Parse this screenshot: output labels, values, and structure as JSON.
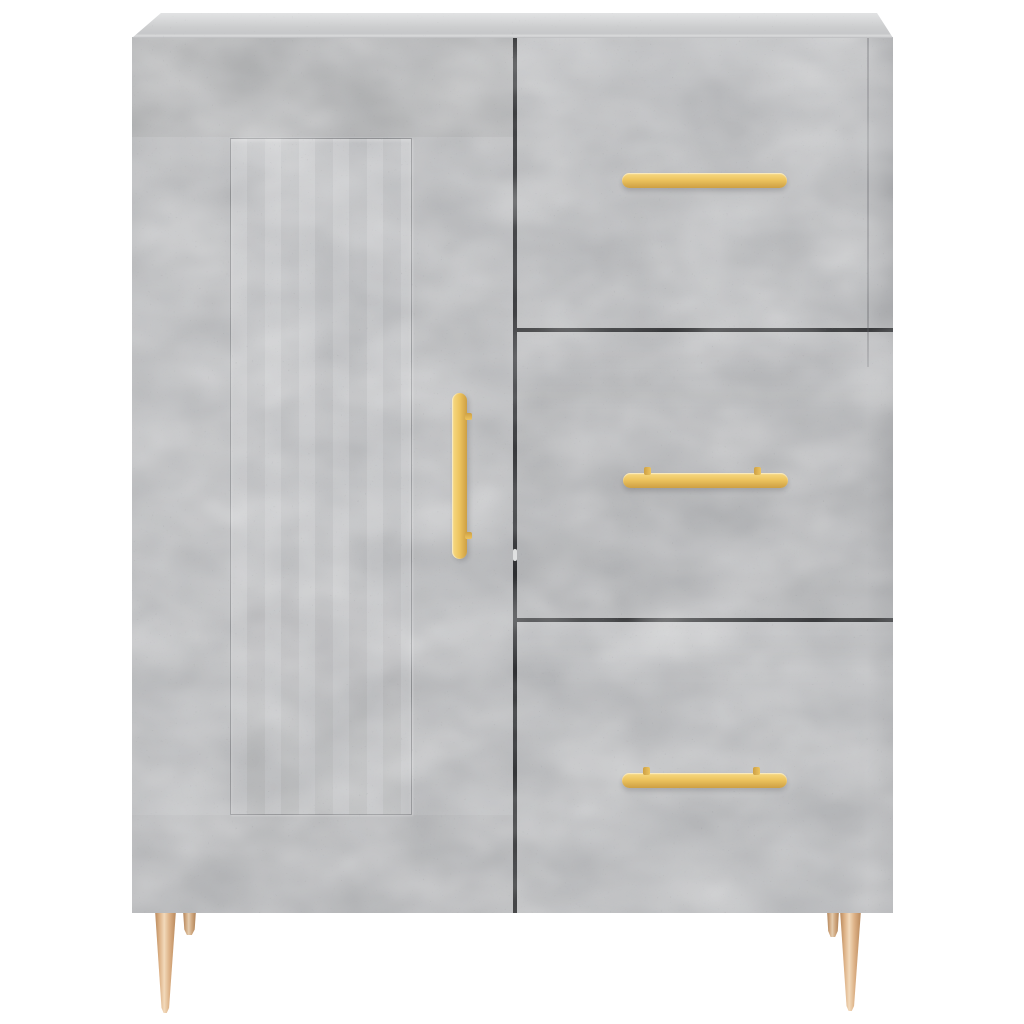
{
  "scene": {
    "type": "product-photo",
    "subject": "sideboard-cabinet",
    "description": "Front view of a concrete-grey sideboard standing on four tapered brass-coloured metal legs against a plain white background. Left half is a hinged door with a recessed rectangular panel and a vertical golden bar handle; right half is a stack of three drawers, each with a horizontal golden bar handle.",
    "background": "white seamless studio background",
    "parts": {
      "top_panel": "flat concrete-grey top seen at a slight angle",
      "door": {
        "count": 1,
        "position": "left",
        "panel": "recessed rectangular inset panel",
        "handle": "vertical golden bar handle, centered on door height near right edge"
      },
      "drawers": {
        "count": 3,
        "position": "right",
        "handle": "horizontal golden bar handle with two mounting posts"
      },
      "legs": {
        "count": 4,
        "visible": 4,
        "style": "slim tapered cone, metal",
        "finish": "brass / copper gold"
      }
    },
    "colors": {
      "background": "#ffffff",
      "concrete_base": "#b9babc",
      "concrete_light": "#cfd0d2",
      "concrete_dark": "#97989b",
      "panel_base": "#c2c3c5",
      "top_light": "#e2e3e4",
      "top_mid": "#cdcecf",
      "gap_dark": "#1e1f21",
      "gold_light": "#f7da85",
      "gold_main": "#edc45f",
      "gold_dark": "#cd9f43",
      "leg_light": "#f2d9ba",
      "leg_main": "#ddb287",
      "leg_dark": "#b9895c"
    }
  }
}
